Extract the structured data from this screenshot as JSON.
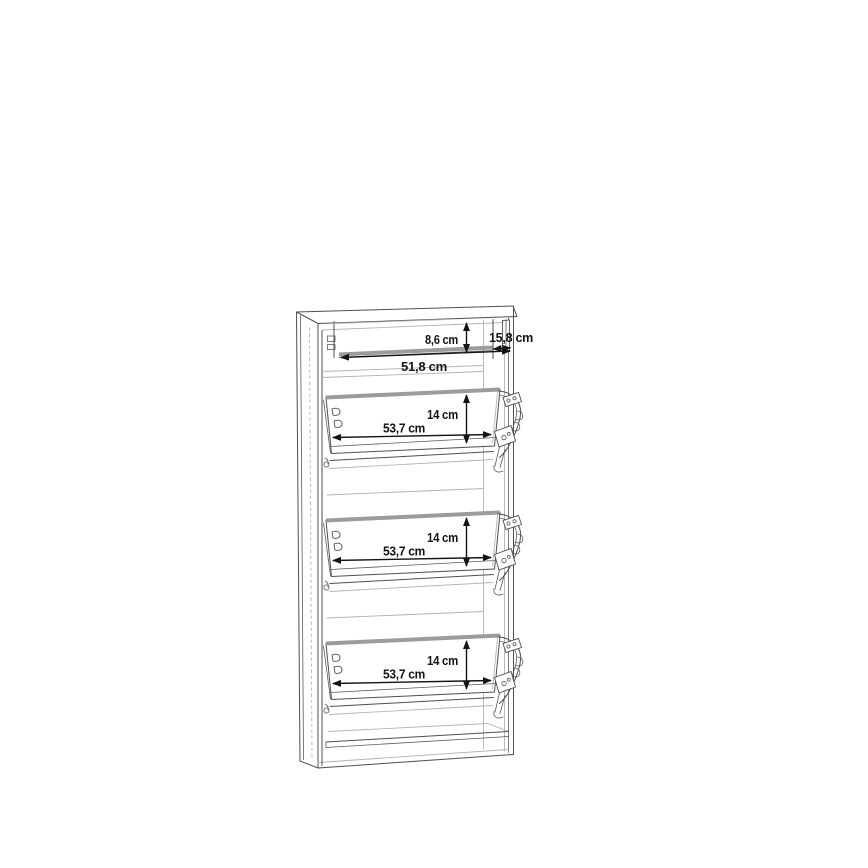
{
  "diagram": {
    "subject": "shoe-cabinet-dimension-drawing",
    "background": "#ffffff",
    "colors": {
      "outline": "#4f4f4f",
      "light_line": "#b3b3b3",
      "shelf_edge_gray": "#9c9c9c",
      "dimension": "#141414"
    },
    "units": "cm",
    "labels": {
      "drawer_height": "8,6 cm",
      "drawer_depth": "15,8 cm",
      "drawer_width": "51,8 cm"
    },
    "flaps": [
      {
        "height": "14 cm",
        "width": "53,7 cm"
      },
      {
        "height": "14 cm",
        "width": "53,7 cm"
      },
      {
        "height": "14 cm",
        "width": "53,7 cm"
      }
    ]
  }
}
